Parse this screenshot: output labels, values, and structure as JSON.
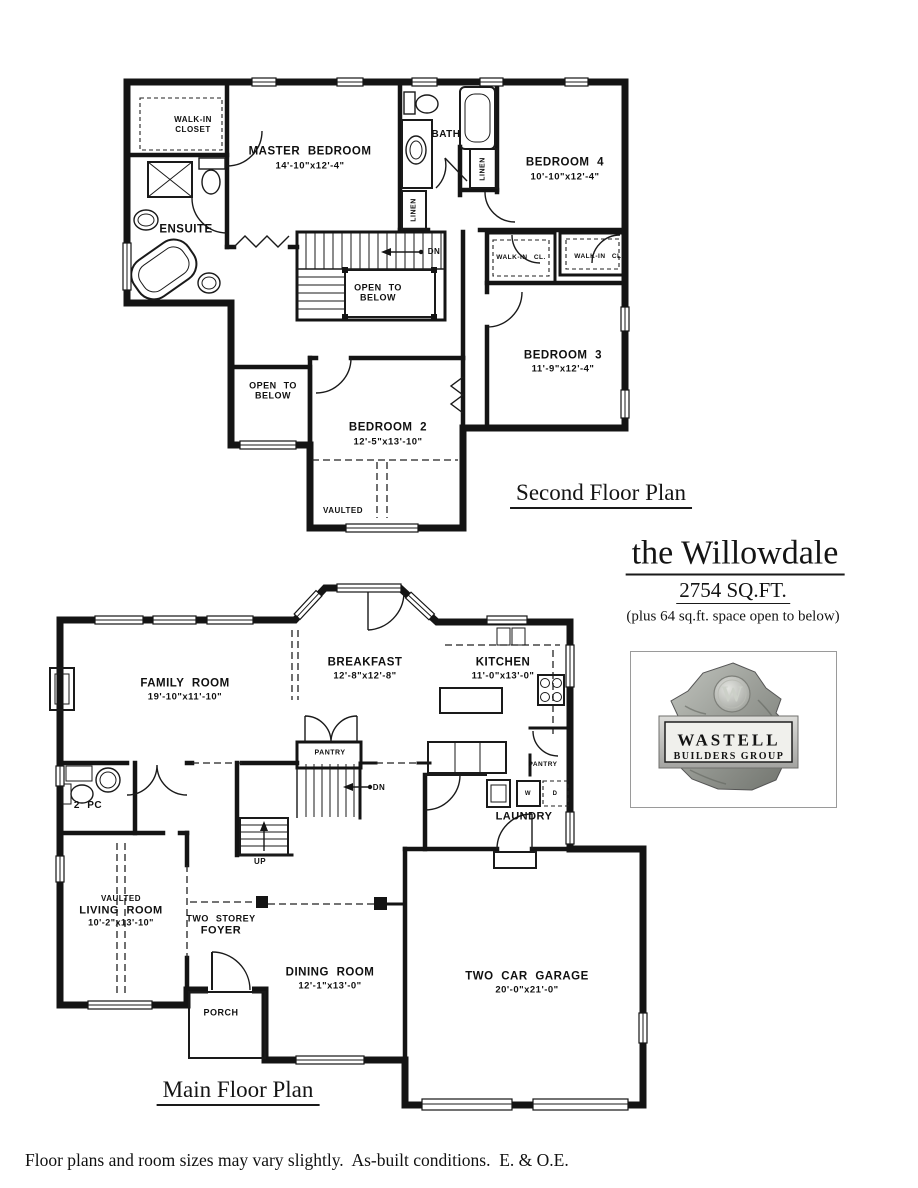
{
  "title": {
    "name": "the Willowdale",
    "sqft": "2754 SQ.FT.",
    "note": "(plus 64 sq.ft. space open to below)"
  },
  "logo": {
    "monogram": "W",
    "line1": "WASTELL",
    "line2": "BUILDERS GROUP"
  },
  "sf": {
    "plan_title": "Second Floor Plan",
    "wic": {
      "l1": "WALK-IN",
      "l2": "CLOSET"
    },
    "master": {
      "n": "MASTER BEDROOM",
      "d": "14'-10\"x12'-4\""
    },
    "bath": "BATH",
    "linen1": "LINEN",
    "linen2": "LINEN",
    "bed4": {
      "n": "BEDROOM 4",
      "d": "10'-10\"x12'-4\""
    },
    "ensuite": "ENSUITE",
    "dn": "DN",
    "otb1": {
      "l1": "OPEN TO",
      "l2": "BELOW"
    },
    "wic1": "WALK-IN CL.",
    "wic2": "WALK-IN CL.",
    "bed3": {
      "n": "BEDROOM 3",
      "d": "11'-9\"x12'-4\""
    },
    "otb2": {
      "l1": "OPEN TO",
      "l2": "BELOW"
    },
    "bed2": {
      "n": "BEDROOM 2",
      "d": "12'-5\"x13'-10\""
    },
    "vaulted": "VAULTED"
  },
  "mf": {
    "plan_title": "Main Floor Plan",
    "family": {
      "n": "FAMILY ROOM",
      "d": "19'-10\"x11'-10\""
    },
    "breakfast": {
      "n": "BREAKFAST",
      "d": "12'-8\"x12'-8\""
    },
    "kitchen": {
      "n": "KITCHEN",
      "d": "11'-0\"x13'-0\""
    },
    "pantry1": "PANTRY",
    "pantry2": "PANTRY",
    "twopc": "2 PC",
    "dn": "DN",
    "up": "UP",
    "laundry": "LAUNDRY",
    "w": "W",
    "d": "D",
    "living": {
      "v": "VAULTED",
      "n": "LIVING ROOM",
      "d": "10'-2\"x13'-10\""
    },
    "foyer": {
      "l1": "TWO STOREY",
      "l2": "FOYER"
    },
    "porch": "PORCH",
    "dining": {
      "n": "DINING ROOM",
      "d": "12'-1\"x13'-0\""
    },
    "garage": {
      "n": "TWO CAR GARAGE",
      "d": "20'-0\"x21'-0\""
    }
  },
  "footer": "Floor plans and room sizes may vary slightly.  As-built conditions.  E. & O.E."
}
